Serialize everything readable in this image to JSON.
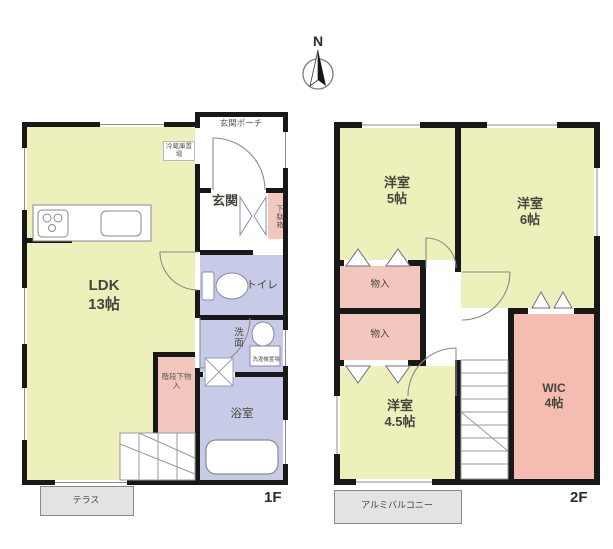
{
  "compass": {
    "label": "N"
  },
  "floor1": {
    "floor_label": "1F",
    "ldk": {
      "name": "LDK",
      "size": "13帖"
    },
    "entrance_porch": "玄関ポーチ",
    "entrance": "玄関",
    "shoe_cabinet": "下駄箱",
    "refrigerator_space": "冷蔵庫置場",
    "toilet": "トイレ",
    "washroom": "洗面",
    "laundry_space": "洗濯機置場",
    "bathroom": "浴室",
    "under_stairs_storage": "階段下物入",
    "terrace": "テラス"
  },
  "floor2": {
    "floor_label": "2F",
    "bedroom_5": {
      "name": "洋室",
      "size": "5帖"
    },
    "bedroom_6": {
      "name": "洋室",
      "size": "6帖"
    },
    "bedroom_45": {
      "name": "洋室",
      "size": "4.5帖"
    },
    "wic": {
      "name": "WIC",
      "size": "4帖"
    },
    "closet_upper": "物入",
    "closet_lower": "物入",
    "balcony": "アルミバルコニー"
  },
  "colors": {
    "wall": "#181818",
    "room_yellow": "#edf0bb",
    "wet_lavender": "#c8cbe7",
    "storage_pink": "#f3c6be",
    "wic_pink": "#f5bcb2",
    "box_gray": "#e3e3e3"
  }
}
